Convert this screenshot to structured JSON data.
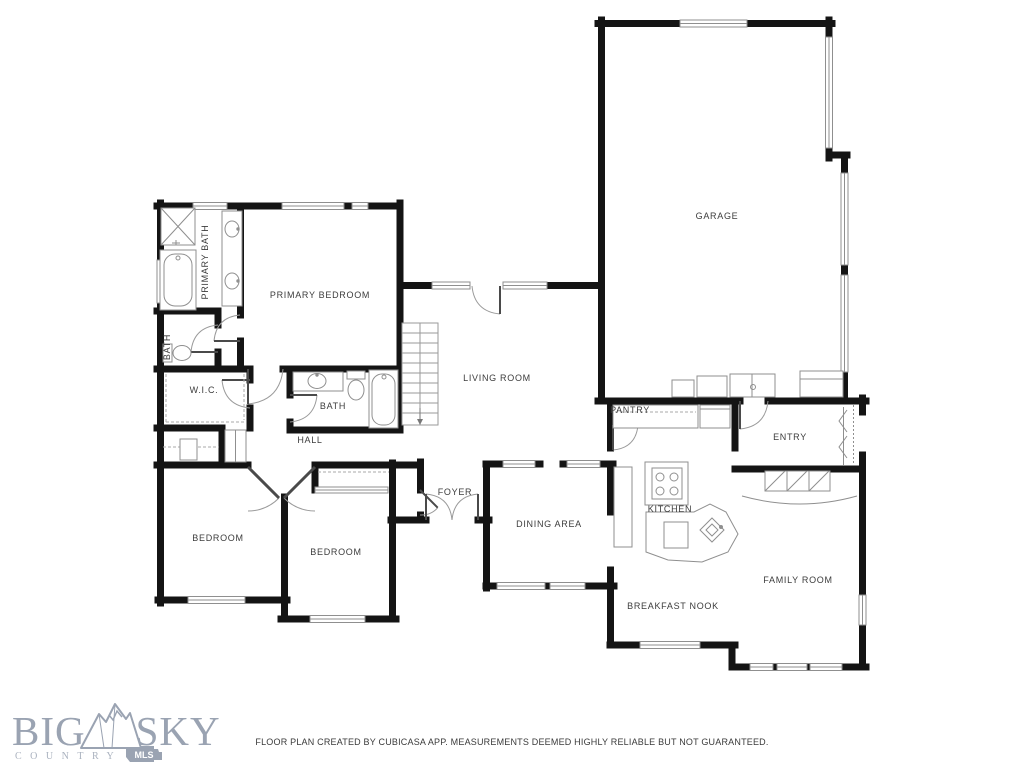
{
  "floor_plan": {
    "rooms": [
      {
        "id": "garage",
        "label": "GARAGE",
        "x": 717,
        "y": 219,
        "rotate": 0
      },
      {
        "id": "primary-bedroom",
        "label": "PRIMARY BEDROOM",
        "x": 320,
        "y": 298,
        "rotate": 0
      },
      {
        "id": "primary-bath",
        "label": "PRIMARY BATH",
        "x": 208,
        "y": 262,
        "rotate": -90
      },
      {
        "id": "bath-toilet",
        "label": "BATH",
        "x": 170,
        "y": 347,
        "rotate": -90
      },
      {
        "id": "wic",
        "label": "W.I.C.",
        "x": 204,
        "y": 393,
        "rotate": 0
      },
      {
        "id": "bath-hall",
        "label": "BATH",
        "x": 333,
        "y": 409,
        "rotate": 0
      },
      {
        "id": "hall",
        "label": "HALL",
        "x": 310,
        "y": 443,
        "rotate": 0
      },
      {
        "id": "bedroom-left",
        "label": "BEDROOM",
        "x": 218,
        "y": 541,
        "rotate": 0
      },
      {
        "id": "bedroom-mid",
        "label": "BEDROOM",
        "x": 336,
        "y": 555,
        "rotate": 0
      },
      {
        "id": "foyer",
        "label": "FOYER",
        "x": 455,
        "y": 495,
        "rotate": 0
      },
      {
        "id": "living-room",
        "label": "LIVING ROOM",
        "x": 497,
        "y": 381,
        "rotate": 0
      },
      {
        "id": "dining-area",
        "label": "DINING AREA",
        "x": 549,
        "y": 527,
        "rotate": 0
      },
      {
        "id": "pantry",
        "label": "PANTRY",
        "x": 630,
        "y": 413,
        "rotate": 0
      },
      {
        "id": "kitchen",
        "label": "KITCHEN",
        "x": 670,
        "y": 512,
        "rotate": 0
      },
      {
        "id": "entry",
        "label": "ENTRY",
        "x": 790,
        "y": 440,
        "rotate": 0
      },
      {
        "id": "family-room",
        "label": "FAMILY ROOM",
        "x": 798,
        "y": 583,
        "rotate": 0
      },
      {
        "id": "breakfast-nook",
        "label": "BREAKFAST NOOK",
        "x": 673,
        "y": 609,
        "rotate": 0
      }
    ]
  },
  "logo": {
    "word1": "BIG",
    "word2": "SKY",
    "subtitle": "COUNTRY",
    "badge": "MLS"
  },
  "footer": {
    "disclaimer": "FLOOR PLAN CREATED BY CUBICASA APP. MEASUREMENTS DEEMED HIGHLY RELIABLE BUT NOT GUARANTEED."
  },
  "colors": {
    "wall": "#141414",
    "fixture": "#8f8f8f",
    "label": "#3c3c3c",
    "logo": "#9aa3b2",
    "footer_text": "#3a3a3a",
    "background": "#ffffff"
  }
}
